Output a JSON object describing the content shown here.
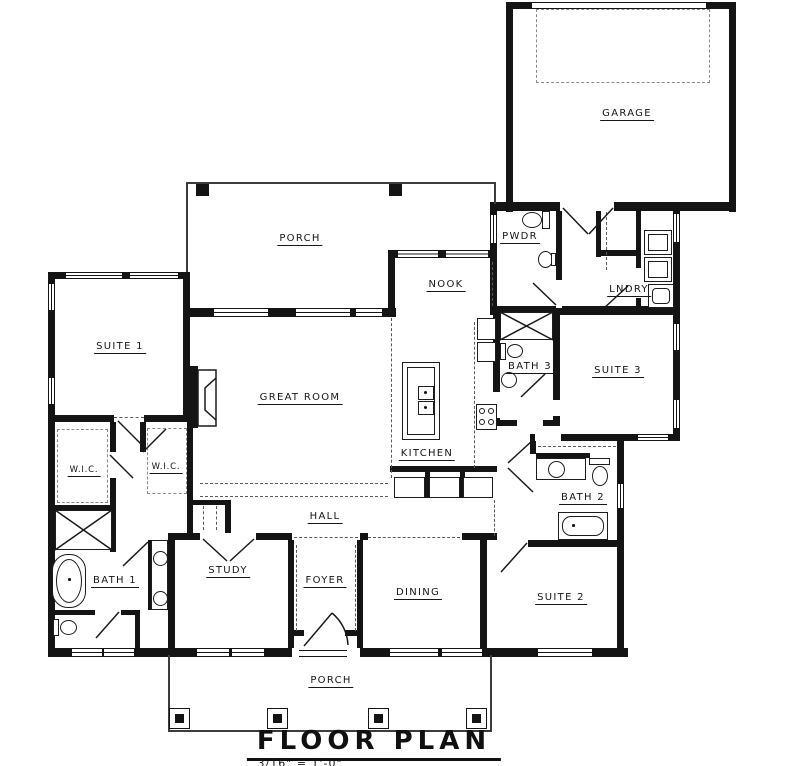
{
  "drawing": {
    "title": "FLOOR PLAN",
    "scale_note": "3/16\" = 1'-0\"",
    "rooms": {
      "garage": "GARAGE",
      "rear_porch": "PORCH",
      "nook": "NOOK",
      "powder": "PWDR",
      "laundry": "LNDRY",
      "suite_1": "SUITE 1",
      "great_room": "GREAT ROOM",
      "kitchen": "KITCHEN",
      "bath_3": "BATH 3",
      "suite_3": "SUITE 3",
      "wic_left": "W.I.C.",
      "wic_right": "W.I.C.",
      "hall": "HALL",
      "bath_1": "BATH 1",
      "bath_2": "BATH 2",
      "study": "STUDY",
      "foyer": "FOYER",
      "dining": "DINING",
      "suite_2": "SUITE 2",
      "front_porch": "PORCH"
    },
    "colors": {
      "wall": "#141414",
      "line": "#3c3c3c",
      "background": "#ffffff"
    }
  }
}
